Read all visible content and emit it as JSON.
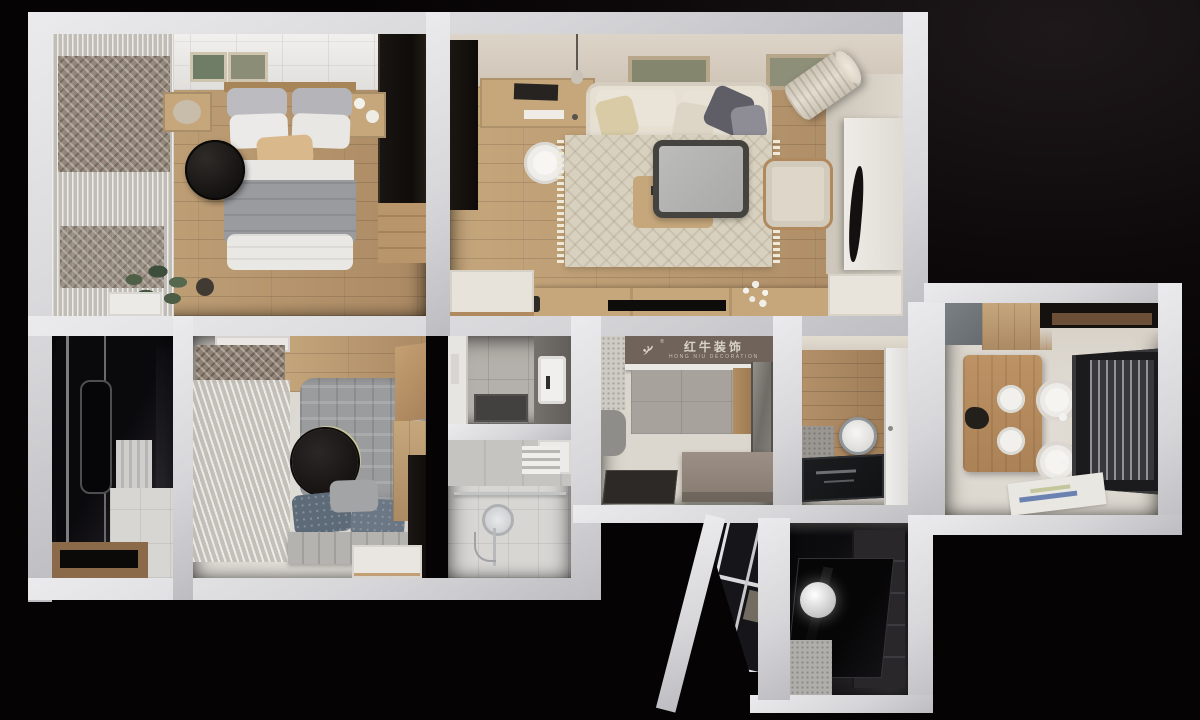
{
  "brand": {
    "name_cn": "红牛装饰",
    "name_en": "HONG NIU DECORATION",
    "registered_mark": "®"
  },
  "palette": {
    "bg": "#070405",
    "wall_hi": "#ebebed",
    "wall": "#d6d6d9",
    "wall_lo": "#bdbdc1",
    "wood": "#ab8a64",
    "wood_light": "#c6a77c",
    "wood_dark": "#8a6a48",
    "cream": "#dcd7ce",
    "tile_gray": "#b4b0ab",
    "tile_light": "#d8d6d3",
    "dark_room": "#131215",
    "logo_wall": "#6f635a",
    "logo_ink": "#d8d2c8",
    "sofa": "#e6e0d3",
    "rug": "#d8d1c0",
    "duvet": "#9a9b9e",
    "tan": "#d9b98c",
    "charcoal": "#1c1a19",
    "slate": "#5f5e66",
    "denim": "#5d6b79"
  }
}
